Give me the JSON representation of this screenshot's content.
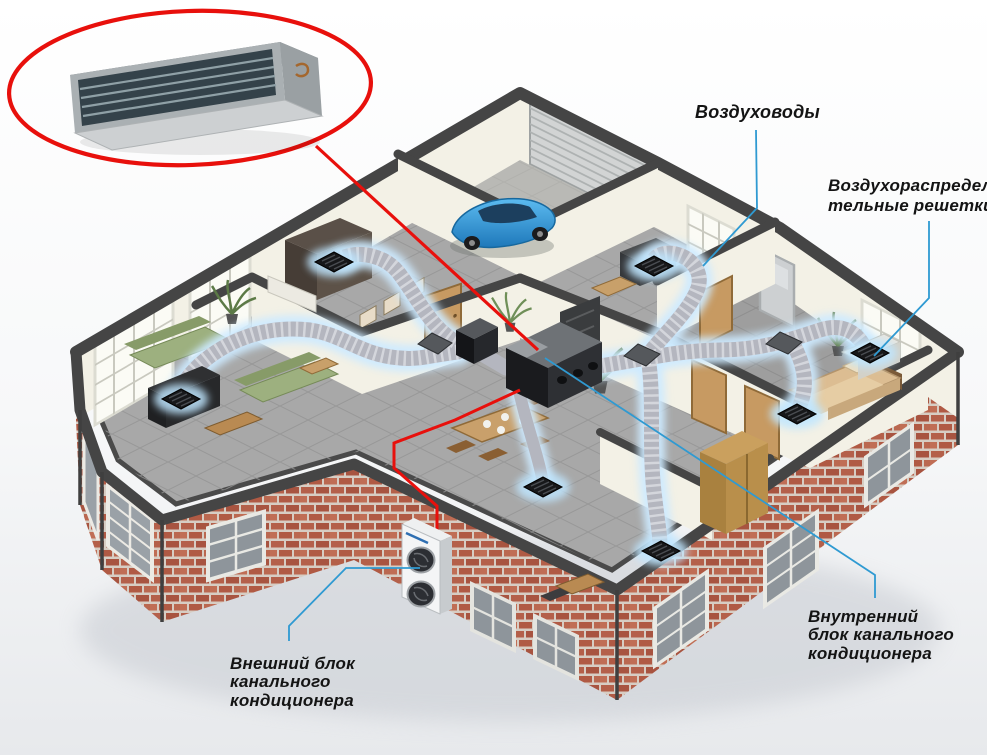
{
  "diagram": {
    "type": "hvac-ducted-air-conditioning-house-cutaway",
    "labels": {
      "ducts": "Воздуховоды",
      "grilles": "Воздухораспредели\nтельные решетки",
      "indoor_unit": "Внутренний\nблок канального\nкондиционера",
      "outdoor_unit": "Внешний блок\nканального\nкондиционера"
    },
    "callout": {
      "shape": "red-ellipse",
      "content": "ducted-indoor-unit-product-photo"
    },
    "colors": {
      "red": "#e8100c",
      "blue": "#2f9ad2",
      "label": "#141414",
      "wallcap": "#454545",
      "wallface": "#f3f1e6",
      "floor": "#a8a8a8",
      "brick": "#b4604a",
      "mortar": "#d7cdc3",
      "duct": "#b4b6bf",
      "ductglow": "#cdeaff",
      "car": "#2f95d8",
      "sofa": "#9db07f",
      "wood": "#b98a52",
      "bedding": "#dcbd92"
    }
  }
}
